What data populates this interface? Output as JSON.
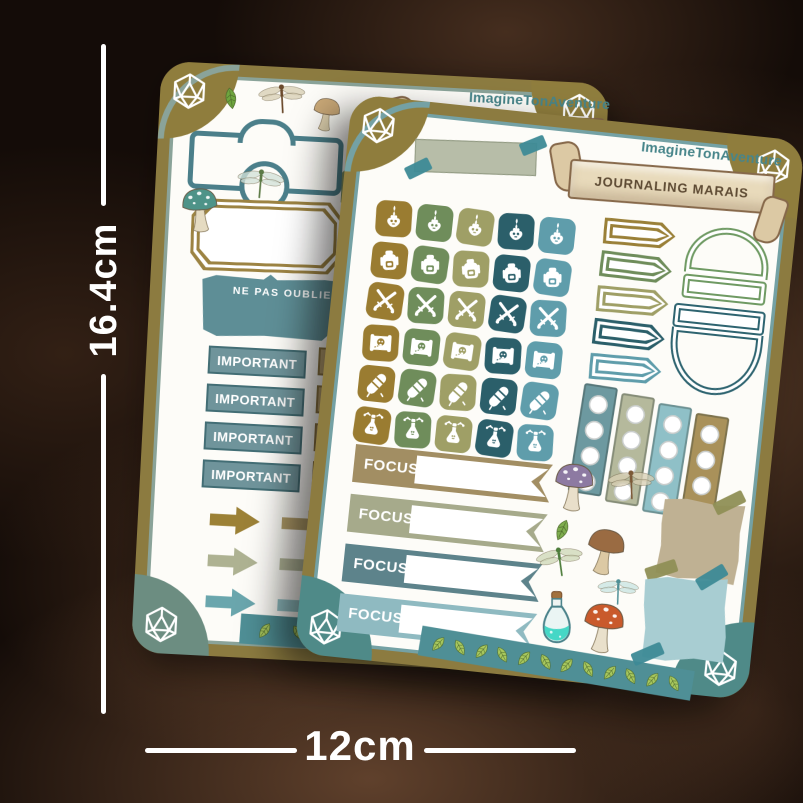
{
  "measurements": {
    "height": "16.4cm",
    "width": "12cm"
  },
  "sheets": {
    "front": {
      "brand": "ImagineTonAventure",
      "title": "JOURNALING MARAIS",
      "focus_labels": [
        "FOCUS",
        "FOCUS",
        "FOCUS",
        "FOCUS"
      ],
      "focus_colors": [
        "#a28e63",
        "#a6aa8b",
        "#5d838b",
        "#8fbac1"
      ],
      "icon_rows": [
        "flame-icon",
        "backpack-icon",
        "crossed-swords-icon",
        "treasure-map-icon",
        "bedroll-icon",
        "potion-sprout-icon"
      ],
      "icon_column_colors": [
        "#9a7c31",
        "#6f8d5b",
        "#9f9f66",
        "#2b5f6a",
        "#5f9dab"
      ],
      "pennant_colors": [
        "#9a8038",
        "#6f8d5b",
        "#9f9f66",
        "#2b5f6a",
        "#5f9dab"
      ],
      "dome_colors": [
        "#6f9a63",
        "#2e6470"
      ],
      "film_strip_colors": [
        "#6d99a0",
        "#b5b99c",
        "#8fc0c7",
        "#a9915a"
      ],
      "washi_tape_color": "#b7bda8",
      "tape_accent_color": "#3d8a96",
      "leaf_strip_color": "#4f8f96",
      "leaf_strip_leaf_count": 12,
      "stickers": [
        {
          "name": "mushroom-purple",
          "cap": "#8d7aa2",
          "stem": "#e9dfca",
          "dots": true
        },
        {
          "name": "dragonfly-tan",
          "body": "#7c5a38",
          "wing": "#d8cfb4"
        },
        {
          "name": "leaf-small",
          "color": "#7fae4f"
        },
        {
          "name": "mushroom-brown",
          "cap": "#9a6b42",
          "stem": "#dcc9a4",
          "dots": false
        },
        {
          "name": "dragonfly-green",
          "body": "#4e7d3c",
          "wing": "#cfd8b8"
        },
        {
          "name": "dragonfly-teal",
          "body": "#4f8f96",
          "wing": "#c9e4e2"
        },
        {
          "name": "potion-bottle",
          "liquid": "#45d7c6",
          "cork": "#a2713e"
        },
        {
          "name": "mushroom-red",
          "cap": "#c95a2c",
          "stem": "#e9e0cb",
          "dots": true
        },
        {
          "name": "paper-scrap-tan",
          "fill": "#bfb193",
          "tape": "#8f8f55"
        },
        {
          "name": "paper-scrap-teal",
          "fill": "#a8cdd2",
          "tape": "#3d8a96"
        }
      ]
    },
    "back": {
      "brand": "ImagineTonAventure",
      "title": "JOURNALING MARAIS",
      "reminder_label": "NE PAS OUBLIER",
      "important_label": "IMPORTANT",
      "objective_label": "OBJECTIF",
      "label_row_count": 4,
      "arrow_colors": [
        [
          "#9c8136",
          "#b5a06b"
        ],
        [
          "#aeb292",
          "#b7bb9d"
        ],
        [
          "#6aa6ad",
          "#93c3c7"
        ]
      ],
      "leaf_strip_color": "#4f8f96",
      "leaf_strip_leaf_count": 7,
      "stickers": [
        {
          "name": "leaf",
          "color": "#6fa63f"
        },
        {
          "name": "dragonfly-brown",
          "body": "#6b4a2c",
          "wing": "#d8cfb4"
        },
        {
          "name": "mushroom-tan",
          "cap": "#c9a877",
          "stem": "#ddd0ae",
          "dots": false
        },
        {
          "name": "mushroom-teal",
          "cap": "#4e9388",
          "stem": "#e5dbc1",
          "dots": true
        },
        {
          "name": "dragonfly-sage",
          "body": "#5c7a46",
          "wing": "#d2e0d8"
        }
      ]
    }
  },
  "corner_icon": "d20-dice-icon",
  "colors": {
    "sheet_border": "#8c7b40",
    "front_inner_line": "#74a1a4",
    "back_inner_line": "#8aa399",
    "corner_gold": "#8f7d3d",
    "corner_teal": "#4f8a88",
    "corner_sage": "#6c8d81",
    "banner_parchment": "#e8dabb",
    "banner_outline": "#86684a",
    "banner_curl": "#dcc9a4",
    "brand_text": "#47858a",
    "title_text": "#5d4a33",
    "reminder_fill": "#b3cccb",
    "reminder_border": "#5e8e96",
    "important_fill": "#6f949b",
    "important_border": "#436e75",
    "objective_fill": "#b9a171",
    "objective_border": "#8a7340",
    "frame_teal": "#4b7f8a",
    "octagon_gold": "#9c8342",
    "ticket_olive": "#7f9464",
    "leaf_green": "#a8c85e",
    "leaf_vein": "#4e6b2c",
    "dimension_line": "#ffffff"
  }
}
